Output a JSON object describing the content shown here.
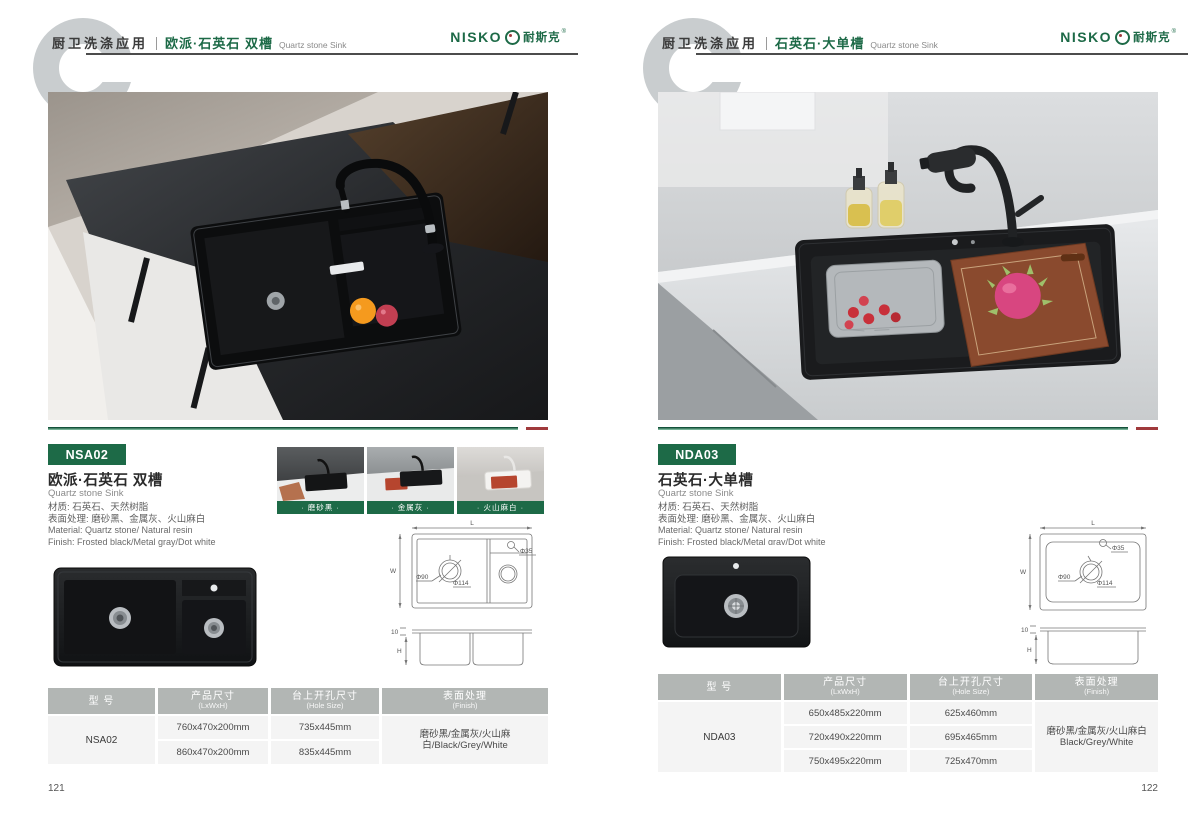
{
  "pages": [
    {
      "page_no": "121",
      "header": {
        "category": "厨卫洗涤应用",
        "product": "欧派·石英石 双槽",
        "product_en": "Quartz stone Sink",
        "logo_en": "NISKO",
        "logo_cn": "耐斯克",
        "logo_reg": "®"
      },
      "badge": "NSA02",
      "info": {
        "title": "欧派·石英石 双槽",
        "subtitle": "Quartz stone Sink",
        "spec_cn1": "材质: 石英石、天然树脂",
        "spec_cn2": "表面处理: 磨砂黑、金属灰、火山麻白",
        "spec_en1": "Material: Quartz stone/ Natural resin",
        "spec_en2": "Finish: Frosted black/Metal gray/Dot white"
      },
      "variants": [
        {
          "label": "· 磨砂黑 ·"
        },
        {
          "label": "· 金属灰 ·"
        },
        {
          "label": "· 火山麻白 ·"
        }
      ],
      "drawing": {
        "dim_l": "L",
        "dim_w": "W",
        "dim_h": "H",
        "hole_top": "Φ35",
        "drain_d1": "Φ90",
        "drain_d2": "Φ114",
        "flange": "10"
      },
      "table": {
        "headers": [
          {
            "t": "型 号",
            "s": ""
          },
          {
            "t": "产品尺寸",
            "s": "(LxWxH)"
          },
          {
            "t": "台上开孔尺寸",
            "s": "(Hole Size)"
          },
          {
            "t": "表面处理",
            "s": "(Finish)"
          }
        ],
        "model": "NSA02",
        "rows": [
          {
            "size": "760x470x200mm",
            "hole": "735x445mm"
          },
          {
            "size": "860x470x200mm",
            "hole": "835x445mm"
          }
        ],
        "finish_line1": "磨砂黑/金属灰/火山麻白/Black/Grey/White",
        "finish_line2": ""
      }
    },
    {
      "page_no": "122",
      "header": {
        "category": "厨卫洗涤应用",
        "product": "石英石·大单槽",
        "product_en": "Quartz stone Sink",
        "logo_en": "NISKO",
        "logo_cn": "耐斯克",
        "logo_reg": "®"
      },
      "badge": "NDA03",
      "info": {
        "title": "石英石·大单槽",
        "subtitle": "Quartz stone Sink",
        "spec_cn1": "材质: 石英石、天然树脂",
        "spec_cn2": "表面处理: 磨砂黑、金属灰、火山麻白",
        "spec_en1": "Material: Quartz stone/ Natural resin",
        "spec_en2": "Finish: Frosted black/Metal gray/Dot white"
      },
      "drawing": {
        "dim_l": "L",
        "dim_w": "W",
        "dim_h": "H",
        "hole_top": "Φ35",
        "drain_d1": "Φ90",
        "drain_d2": "Φ114",
        "flange": "10"
      },
      "table": {
        "headers": [
          {
            "t": "型 号",
            "s": ""
          },
          {
            "t": "产品尺寸",
            "s": "(LxWxH)"
          },
          {
            "t": "台上开孔尺寸",
            "s": "(Hole Size)"
          },
          {
            "t": "表面处理",
            "s": "(Finish)"
          }
        ],
        "model": "NDA03",
        "rows": [
          {
            "size": "650x485x220mm",
            "hole": "625x460mm"
          },
          {
            "size": "720x490x220mm",
            "hole": "695x465mm"
          },
          {
            "size": "750x495x220mm",
            "hole": "725x470mm"
          }
        ],
        "finish_line1": "磨砂黑/金属灰/火山麻白",
        "finish_line2": "Black/Grey/White"
      }
    }
  ]
}
